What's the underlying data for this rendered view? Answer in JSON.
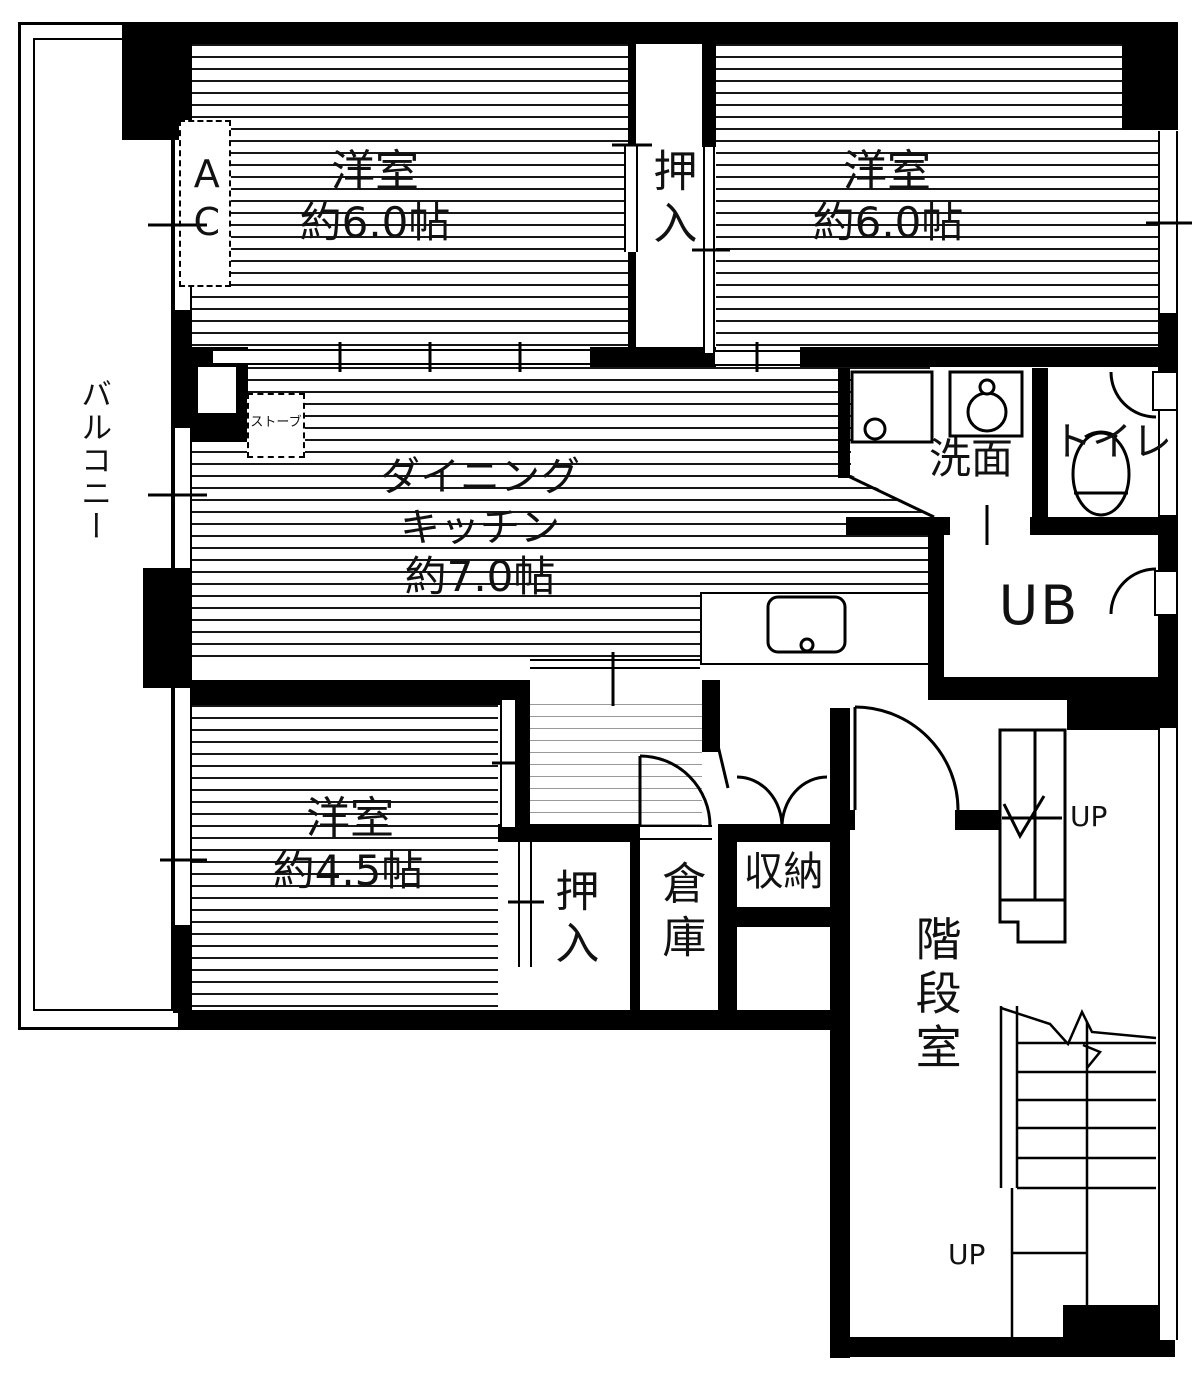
{
  "plan": {
    "type": "floorplan",
    "layout_name": "3DK apartment unit with central stair hall",
    "rooms": {
      "balcony": {
        "label": "バルコニー"
      },
      "bedroom_nw": {
        "name": "洋室",
        "size": "約6.0帖"
      },
      "bedroom_ne": {
        "name": "洋室",
        "size": "約6.0帖"
      },
      "closet_top": {
        "label": "押入"
      },
      "dining_kitchen": {
        "name_line1": "ダイニング",
        "name_line2": "キッチン",
        "size": "約7.0帖"
      },
      "washroom": {
        "label": "洗面"
      },
      "toilet": {
        "label": "トイレ"
      },
      "unit_bath": {
        "label": "UB"
      },
      "bedroom_sw": {
        "name": "洋室",
        "size": "約4.5帖"
      },
      "closet_bottom": {
        "label": "押入"
      },
      "storage": {
        "label": "倉庫"
      },
      "cabinet": {
        "label": "収納"
      },
      "stairwell": {
        "label": "階段室"
      }
    },
    "fixtures": {
      "air_conditioner": "AC",
      "stove": "ストーブ"
    },
    "stairs": {
      "up_label_top": "UP",
      "up_label_bottom": "UP"
    },
    "colors": {
      "wall": "#000000",
      "background": "#ffffff",
      "hallway_hatch": "#9a9a9a"
    }
  }
}
